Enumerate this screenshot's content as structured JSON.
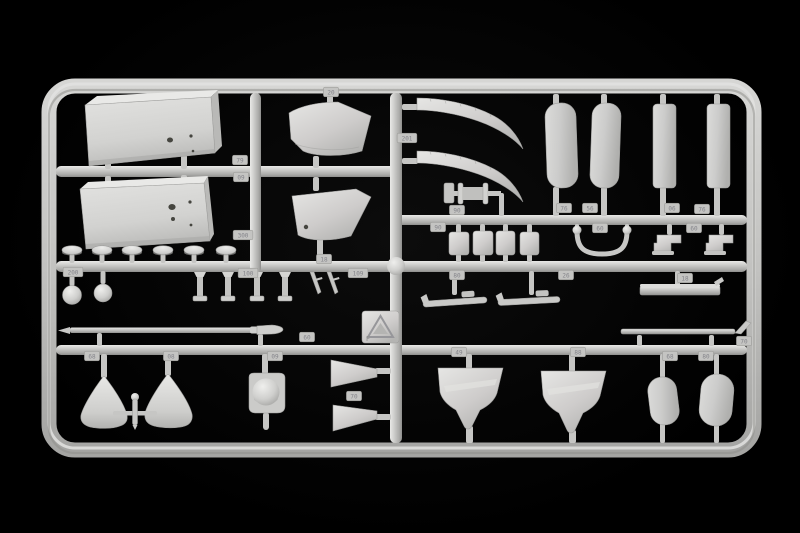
{
  "meta": {
    "subject": "Photograph of an injection-molded model kit sprue (runner frame) with unpainted light gray plastic parts on a black background",
    "background_color": "#000000",
    "plastic_color": "#c9c9c7",
    "plastic_highlight": "#e9e9e7",
    "plastic_shadow": "#8e8e8c"
  },
  "stamp": {
    "symbol": "triangle-logo",
    "letter": "F"
  },
  "part_tags": [
    {
      "value": "200",
      "cx": 73,
      "cy": 272
    },
    {
      "value": "79",
      "cx": 240,
      "cy": 160
    },
    {
      "value": "09",
      "cx": 241,
      "cy": 177
    },
    {
      "value": "300",
      "cx": 243,
      "cy": 235
    },
    {
      "value": "100",
      "cx": 248,
      "cy": 273
    },
    {
      "value": "109",
      "cx": 358,
      "cy": 273
    },
    {
      "value": "20",
      "cx": 331,
      "cy": 92
    },
    {
      "value": "18",
      "cx": 324,
      "cy": 259
    },
    {
      "value": "68",
      "cx": 92,
      "cy": 356
    },
    {
      "value": "08",
      "cx": 171,
      "cy": 356
    },
    {
      "value": "09",
      "cx": 275,
      "cy": 356
    },
    {
      "value": "60",
      "cx": 307,
      "cy": 337
    },
    {
      "value": "70",
      "cx": 354,
      "cy": 396
    },
    {
      "value": "201",
      "cx": 407,
      "cy": 138
    },
    {
      "value": "90",
      "cx": 457,
      "cy": 210
    },
    {
      "value": "90",
      "cx": 438,
      "cy": 227
    },
    {
      "value": "76",
      "cx": 564,
      "cy": 208
    },
    {
      "value": "56",
      "cx": 590,
      "cy": 208
    },
    {
      "value": "06",
      "cx": 672,
      "cy": 208
    },
    {
      "value": "76",
      "cx": 702,
      "cy": 209
    },
    {
      "value": "60",
      "cx": 600,
      "cy": 228
    },
    {
      "value": "60",
      "cx": 694,
      "cy": 228
    },
    {
      "value": "80",
      "cx": 457,
      "cy": 275
    },
    {
      "value": "26",
      "cx": 566,
      "cy": 275
    },
    {
      "value": "18",
      "cx": 685,
      "cy": 278
    },
    {
      "value": "70",
      "cx": 744,
      "cy": 341
    },
    {
      "value": "49",
      "cx": 459,
      "cy": 352
    },
    {
      "value": "88",
      "cx": 578,
      "cy": 352
    },
    {
      "value": "68",
      "cx": 670,
      "cy": 356
    },
    {
      "value": "80",
      "cx": 706,
      "cy": 356
    }
  ],
  "parts_inventory": [
    "large equipment box upper-left",
    "large equipment box lower-left",
    "curved cowl panel x2",
    "domed cap x6",
    "small sphere x2",
    "pedestal column x4",
    "angled pin x2",
    "long pointed rod",
    "conical fairing x2",
    "cross-shaped fitting",
    "domed fairing on plate",
    "tapered wedge x2",
    "curved blade x2",
    "flanged spool",
    "rounded slab panel x2",
    "flat strip x2",
    "small box x4",
    "U-shaped tow bar",
    "stepped bracket x2",
    "runner rack x3",
    "thin skid strip with hook",
    "shield-shaped seat x2",
    "rounded pod x2",
    "mold stamp plate"
  ]
}
